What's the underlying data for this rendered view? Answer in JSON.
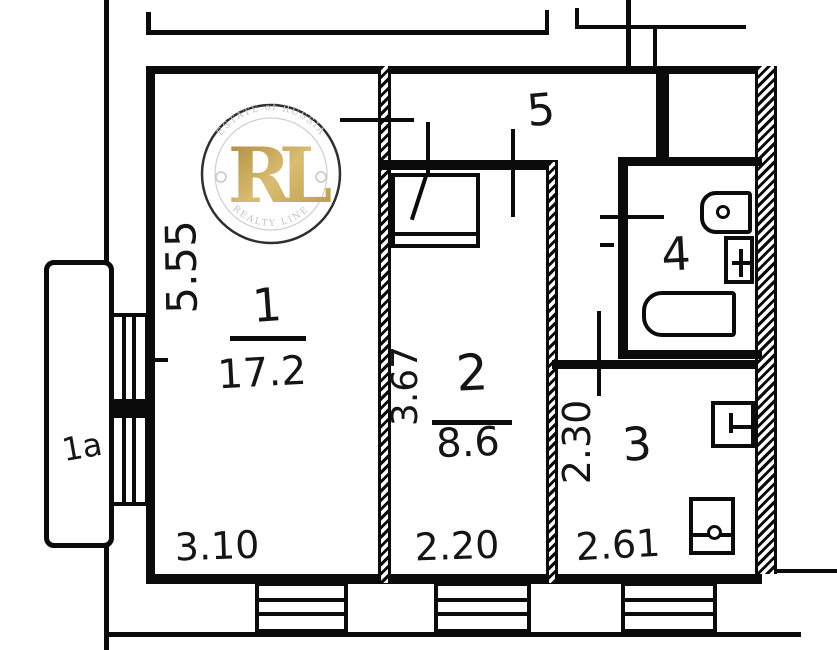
{
  "watermark": {
    "top_text": "ESTATE of RUSSIA",
    "bottom_text": "REALTY LINE",
    "center_text": "RL",
    "gold_color": "#c3a04c",
    "ring_text_color": "#c6c6c6"
  },
  "plan": {
    "background_color": "#ffffff",
    "line_color": "#0b0b0b",
    "corridor": {
      "number": "5"
    },
    "balcony": {
      "number": "1a"
    },
    "room1": {
      "number": "1",
      "area": "17.2",
      "width": "3.10",
      "depth": "5.55"
    },
    "room2": {
      "number": "2",
      "area": "8.6",
      "width": "2.20",
      "depth": "3.67"
    },
    "room3": {
      "number": "3",
      "width": "2.61",
      "depth": "2.30"
    },
    "bathroom": {
      "number": "4"
    }
  }
}
